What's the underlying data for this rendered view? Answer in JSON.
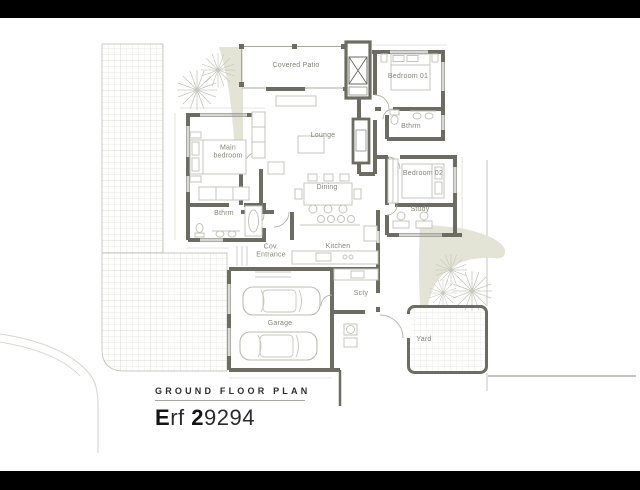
{
  "title_block": {
    "plan_title": "GROUND FLOOR PLAN",
    "erf_parts": [
      {
        "text": "E",
        "bold": true
      },
      {
        "text": "rf ",
        "bold": false
      },
      {
        "text": "2",
        "bold": true
      },
      {
        "text": "9294",
        "bold": false
      }
    ]
  },
  "rooms": {
    "covered_patio": {
      "label": "Covered Patio"
    },
    "bedroom_01": {
      "label": "Bedroom 01"
    },
    "bathroom_right": {
      "label": "Bthrm"
    },
    "bedroom_02": {
      "label": "Bedroom 02"
    },
    "study": {
      "label": "Study"
    },
    "lounge": {
      "label": "Lounge"
    },
    "dining": {
      "label": "Dining"
    },
    "main_bedroom": {
      "label": "Main bedroom"
    },
    "bathroom_left": {
      "label": "Bthrm"
    },
    "covered_entrance": {
      "label": "Cov. Entrance"
    },
    "kitchen": {
      "label": "Kitchen"
    },
    "scullery": {
      "label": "Scty"
    },
    "garage": {
      "label": "Garage"
    },
    "yard": {
      "label": "Yard"
    }
  },
  "colors": {
    "wall": "#6c6c62",
    "label_text": "#86867b",
    "paving_line": "#e4e4df",
    "landscape_fill": "#e3e4d6",
    "tree_line": "#c7c7bf",
    "title_text": "#141414",
    "letterbox": "#000000"
  }
}
